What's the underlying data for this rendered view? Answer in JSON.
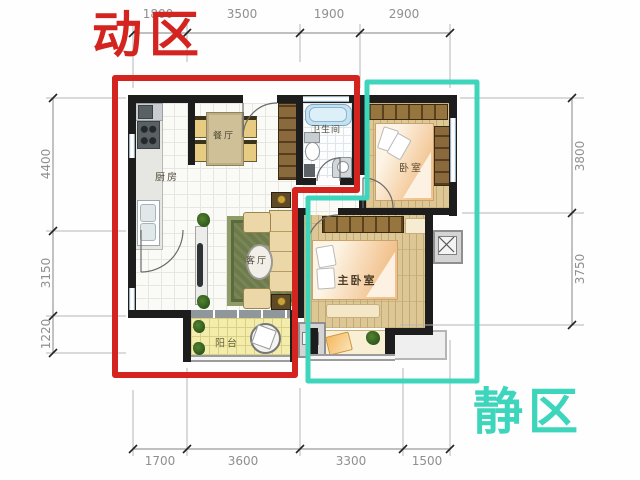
{
  "zones": {
    "active": {
      "label": "动区",
      "color": "#d32420"
    },
    "quiet": {
      "label": "静区",
      "color": "#3dd6bd"
    }
  },
  "rooms": {
    "kitchen": {
      "label": "厨房"
    },
    "dining": {
      "label": "餐厅"
    },
    "bathroom": {
      "label": "卫生间"
    },
    "bedroom": {
      "label": "卧室"
    },
    "living": {
      "label": "客厅"
    },
    "master_bedroom": {
      "label": "主卧室"
    },
    "balcony": {
      "label": "阳台"
    }
  },
  "dimensions": {
    "top": [
      "1800",
      "3500",
      "1900",
      "2900"
    ],
    "bottom": [
      "1700",
      "3600",
      "3300",
      "1500"
    ],
    "left": [
      "4400",
      "3150",
      "1220"
    ],
    "right": [
      "3800",
      "3750"
    ]
  }
}
